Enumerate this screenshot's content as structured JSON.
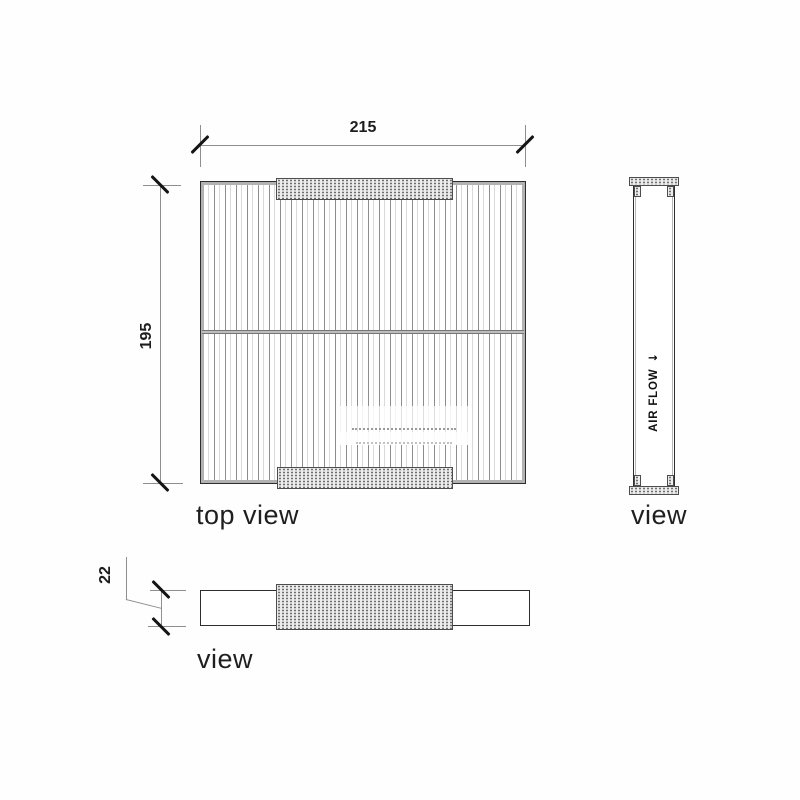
{
  "views": {
    "top": {
      "label": "top view",
      "width_dim": "215",
      "height_dim": "195"
    },
    "side": {
      "label": "view",
      "air_flow_text": "AIR FLOW",
      "air_flow_arrow": "↓"
    },
    "front": {
      "label": "view",
      "thickness_dim": "22"
    }
  },
  "colors": {
    "ink": "#1b1b1b",
    "dimension_line": "#8f8f8f",
    "pleat_line": "#8d8d8d",
    "tab_fill": "#ececec",
    "background": "#fefefe"
  }
}
